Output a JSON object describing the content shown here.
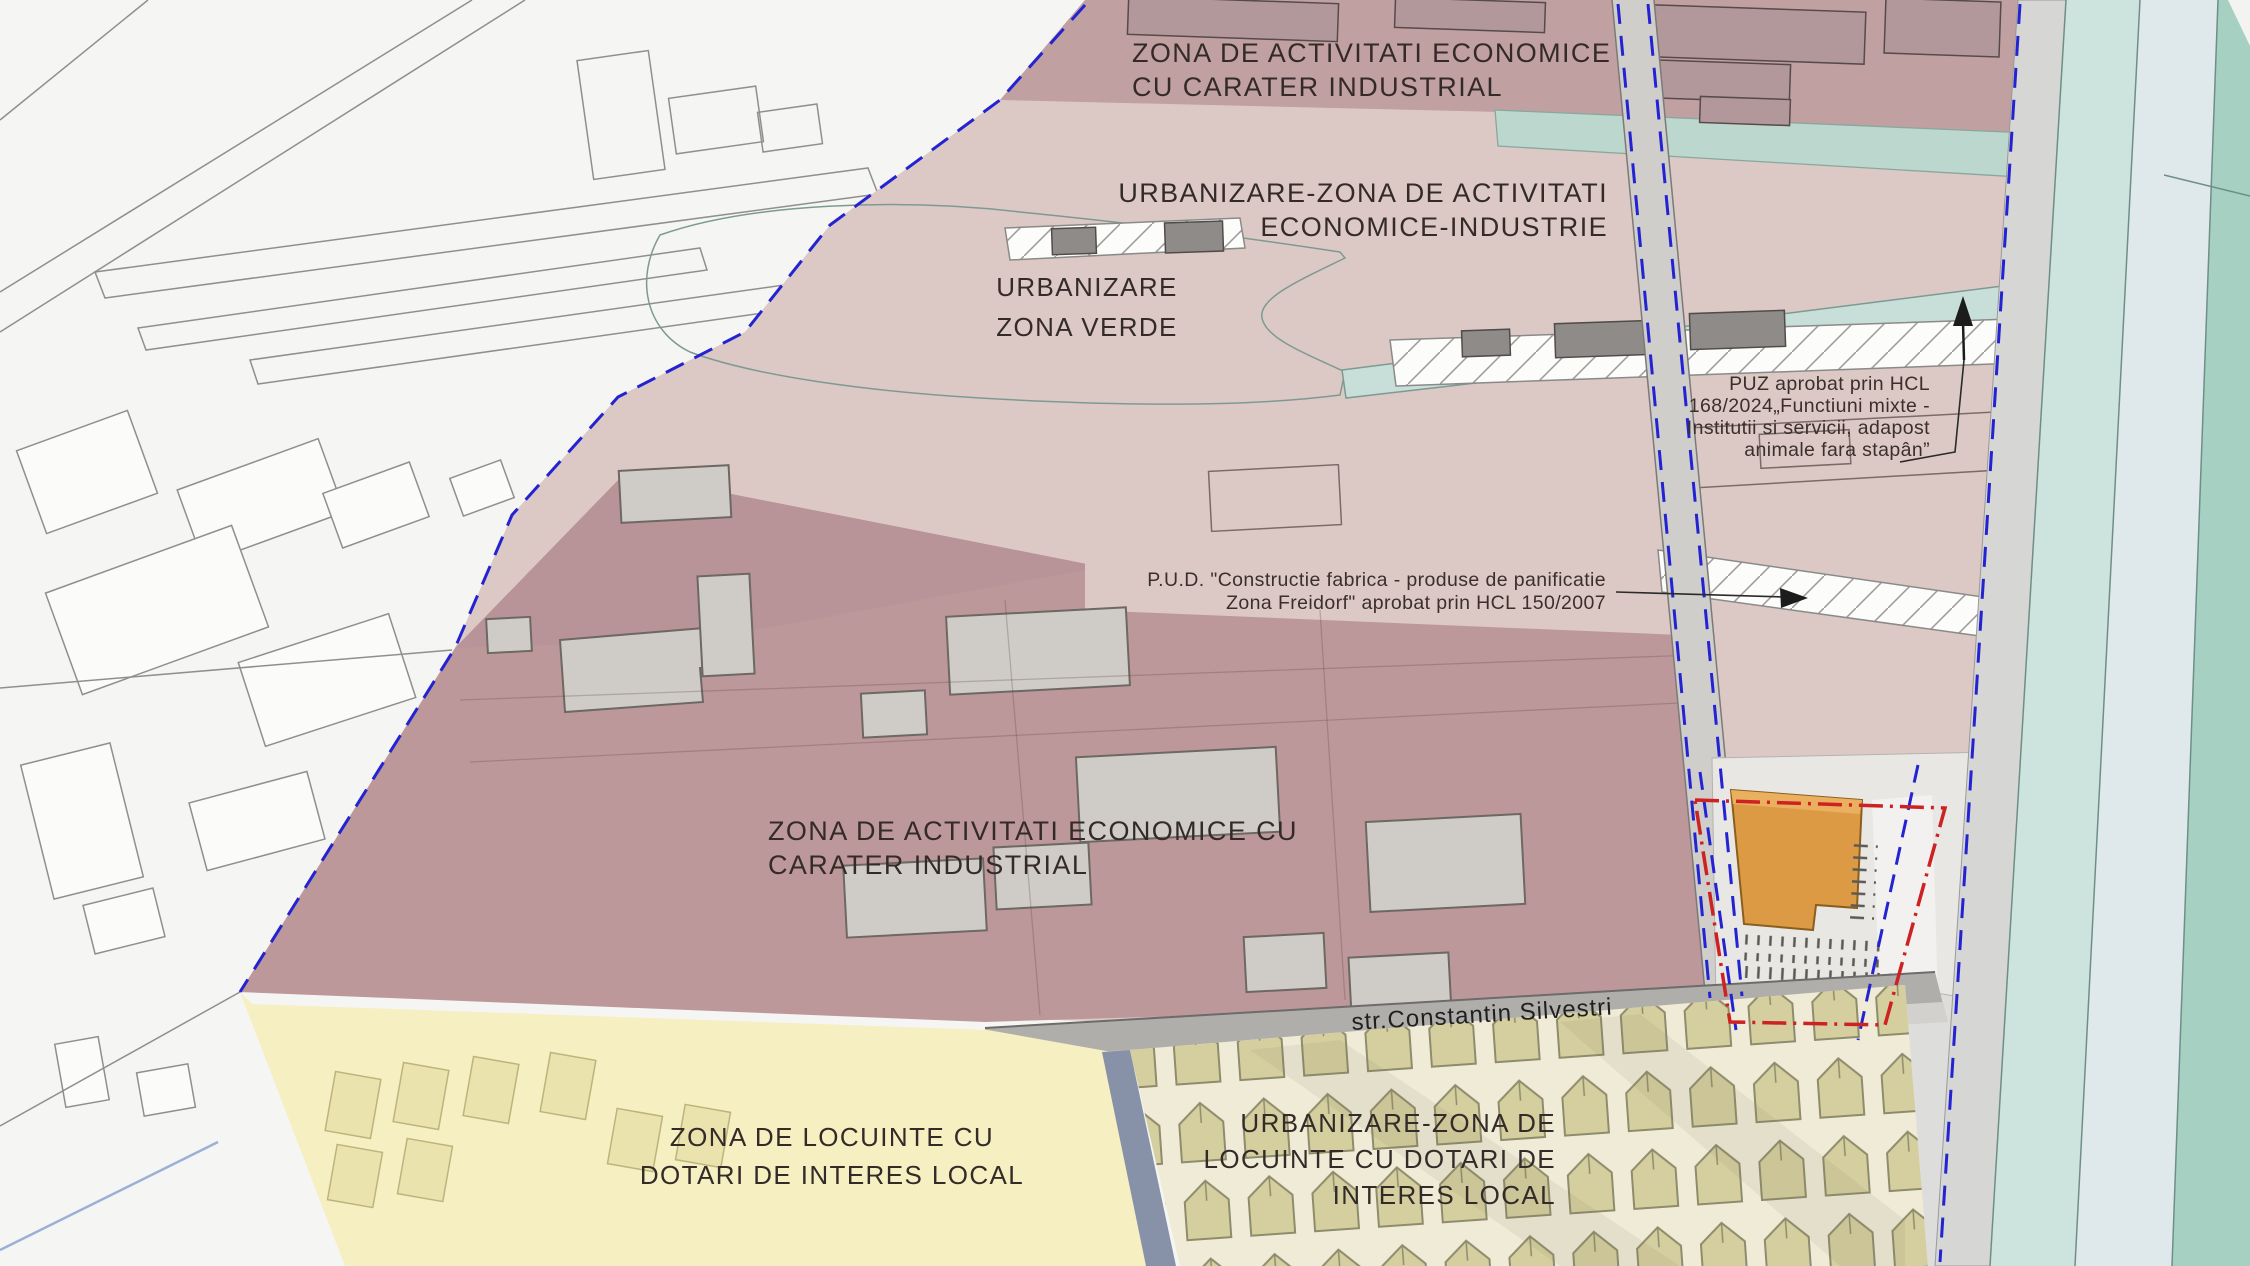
{
  "map": {
    "labels": {
      "zone_industrial_top": {
        "line1": "ZONA DE ACTIVITATI ECONOMICE",
        "line2": "CU CARATER INDUSTRIAL"
      },
      "zone_urbanizare_industrie": {
        "line1": "URBANIZARE-ZONA DE ACTIVITATI",
        "line2": "ECONOMICE-INDUSTRIE"
      },
      "zone_verde": {
        "line1": "URBANIZARE",
        "line2": "ZONA VERDE"
      },
      "zone_industrial_central": {
        "line1": "ZONA DE ACTIVITATI ECONOMICE CU",
        "line2": "CARATER INDUSTRIAL"
      },
      "zone_locuinte": {
        "line1": "ZONA DE LOCUINTE CU",
        "line2": "DOTARI DE INTERES LOCAL"
      },
      "zone_urbanizare_locuinte": {
        "line1": "URBANIZARE-ZONA DE",
        "line2": "LOCUINTE CU DOTARI DE",
        "line3": "INTERES LOCAL"
      },
      "street": "str.Constantin Silvestri"
    },
    "annotations": {
      "puz": {
        "line1": "PUZ aprobat prin HCL",
        "line2": "168/2024„Functiuni mixte -",
        "line3": "Institutii si servicii, adapost",
        "line4": "animale fara stapân”"
      },
      "pud": {
        "line1": "P.U.D. \"Constructie fabrica - produse de panificatie",
        "line2": "Zona Freidorf\" aprobat prin HCL 150/2007"
      }
    },
    "colors": {
      "zone_industrial_top": "#c1a0a2",
      "zone_industrial_central": "#bd989b",
      "zone_urbanizare_industrie": "#dcc9c5",
      "zone_verde": "#c8dfd9",
      "zone_locuinte": "#f5efc1",
      "zone_urbanizare_locuinte": "#f0ebd7",
      "housing_units": "#d5cfa0",
      "street_band": "#b0aeab",
      "road_slate": "#8791a8",
      "canal_teal": "#cde3dd",
      "canal_channel": "#dfe9ec",
      "canal_teal_dark": "#a6d0c2",
      "site_building_orange": "#dd9a44",
      "boundary_blue": "#2323d2",
      "site_outline_red": "#cc2222"
    }
  }
}
